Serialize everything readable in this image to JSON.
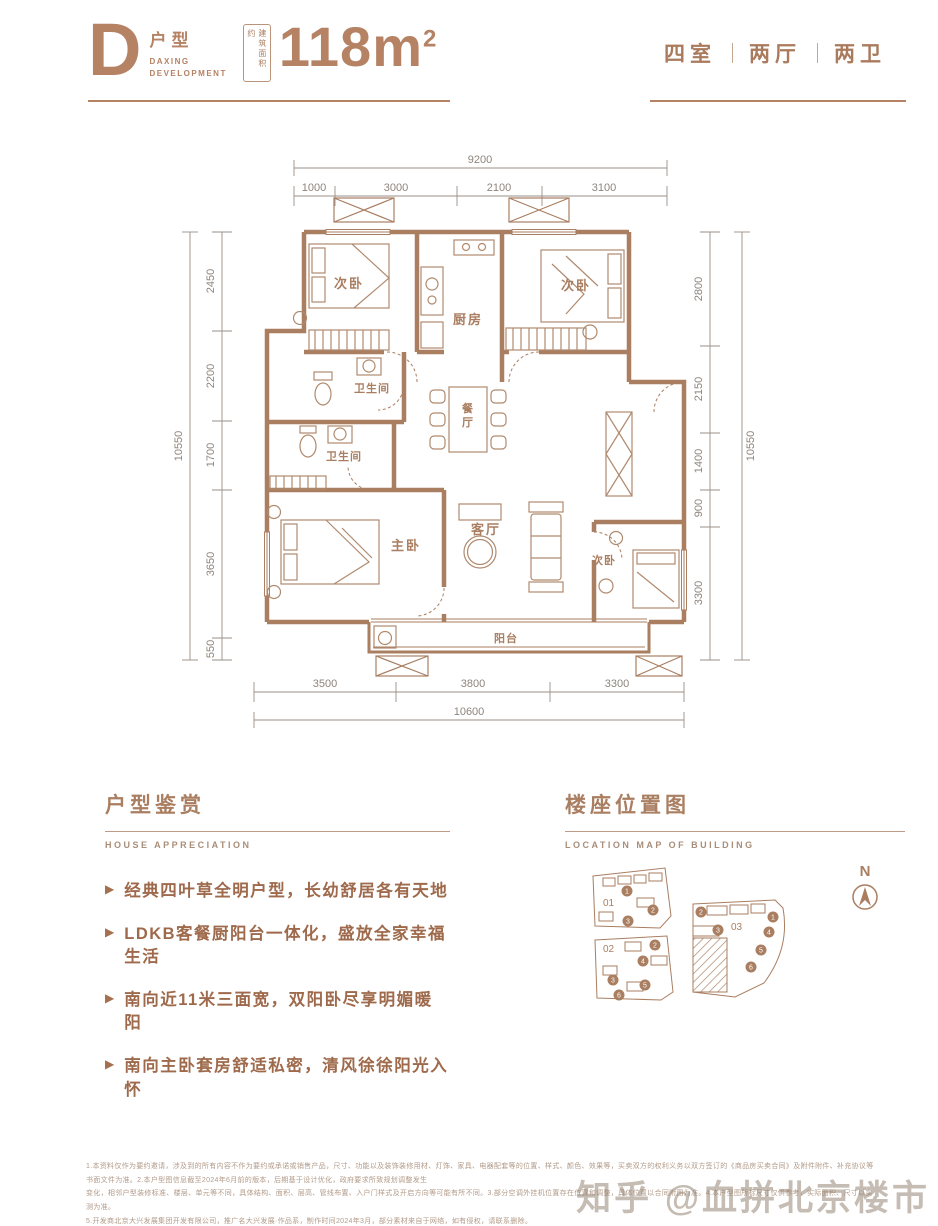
{
  "colors": {
    "accent": "#a97e61",
    "dim_text": "#8e847c",
    "header_brown": "#b58264",
    "bullet_text": "#9e6a4b"
  },
  "header": {
    "letter": "D",
    "type_label": "户型",
    "brand_line1": "DAXING",
    "brand_line2": "DEVELOPMENT",
    "area_badge": "建筑面积约",
    "area_value": "118m",
    "area_sup": "2",
    "rooms_spec": [
      "四室",
      "两厅",
      "两卫"
    ]
  },
  "plan": {
    "dims_top": {
      "total": "9200",
      "segments": [
        "1000",
        "3000",
        "2100",
        "3100"
      ]
    },
    "dims_left": {
      "total": "10550",
      "segments": [
        "2450",
        "2200",
        "1700",
        "3650",
        "550"
      ]
    },
    "dims_right": {
      "total": "10550",
      "segments": [
        "2800",
        "2150",
        "1400",
        "900",
        "3300"
      ]
    },
    "dims_bottom": {
      "total": "10600",
      "segments": [
        "3500",
        "3800",
        "3300"
      ]
    },
    "rooms": {
      "bedroom_top_left": "次卧",
      "kitchen": "厨房",
      "bedroom_top_right": "次卧",
      "bath_upper": "卫生间",
      "bath_lower": "卫生间",
      "dining_char1": "餐",
      "dining_char2": "厅",
      "master": "主卧",
      "living": "客厅",
      "bedroom_bottom_right": "次卧",
      "balcony": "阳台"
    }
  },
  "appreciation": {
    "title": "户型鉴赏",
    "subtitle": "HOUSE APPRECIATION",
    "points": [
      "经典四叶草全明户型，长幼舒居各有天地",
      "LDKB客餐厨阳台一体化，盛放全家幸福生活",
      "南向近11米三面宽，双阳卧尽享明媚暖阳",
      "南向主卧套房舒适私密，清风徐徐阳光入怀"
    ]
  },
  "location": {
    "title": "楼座位置图",
    "subtitle": "LOCATION MAP OF BUILDING",
    "north_label": "N",
    "parcel01": {
      "label": "01",
      "badges": [
        "1",
        "2",
        "3"
      ]
    },
    "parcel02": {
      "label": "02",
      "badges": [
        "2",
        "4",
        "3",
        "5",
        "6"
      ]
    },
    "parcel03": {
      "label": "03",
      "badges": [
        "2",
        "1",
        "3",
        "4",
        "5",
        "6"
      ]
    }
  },
  "footer": {
    "lines": [
      "1.本资料仅作为要约邀请，涉及到的所有内容不作为要约或承诺或销售产品，尺寸、功能以及装饰装修用材、灯饰、家具、电器配套等的位置、样式、颜色、效果等，买卖双方的权利义务以双方签订的《商品房买卖合同》及附件附件、补充协议等书面文件为准。2.本户型图信息截至2024年6月前的版本，后期基于设计优化，政府要求所致规划调整发生",
      "变化，相邻户型装修标准、楼层、单元等不同，具体结构、面积、层高、管线布置、入户门样式及开启方向等可能有所不同。3.部分空调外挂机位置存在位置和调整，具体位置以合同附图为准。4.本户型图所标尺寸仅供参考，实际面积、尺寸以实测为准。",
      "5.开发商北京大兴发展集团开发有限公司，推广名大兴发展·作品系，制作时间2024年3月，部分素材来自于网络，如有侵权，请联系删除。"
    ],
    "watermark": "知乎 @血拼北京楼市"
  }
}
